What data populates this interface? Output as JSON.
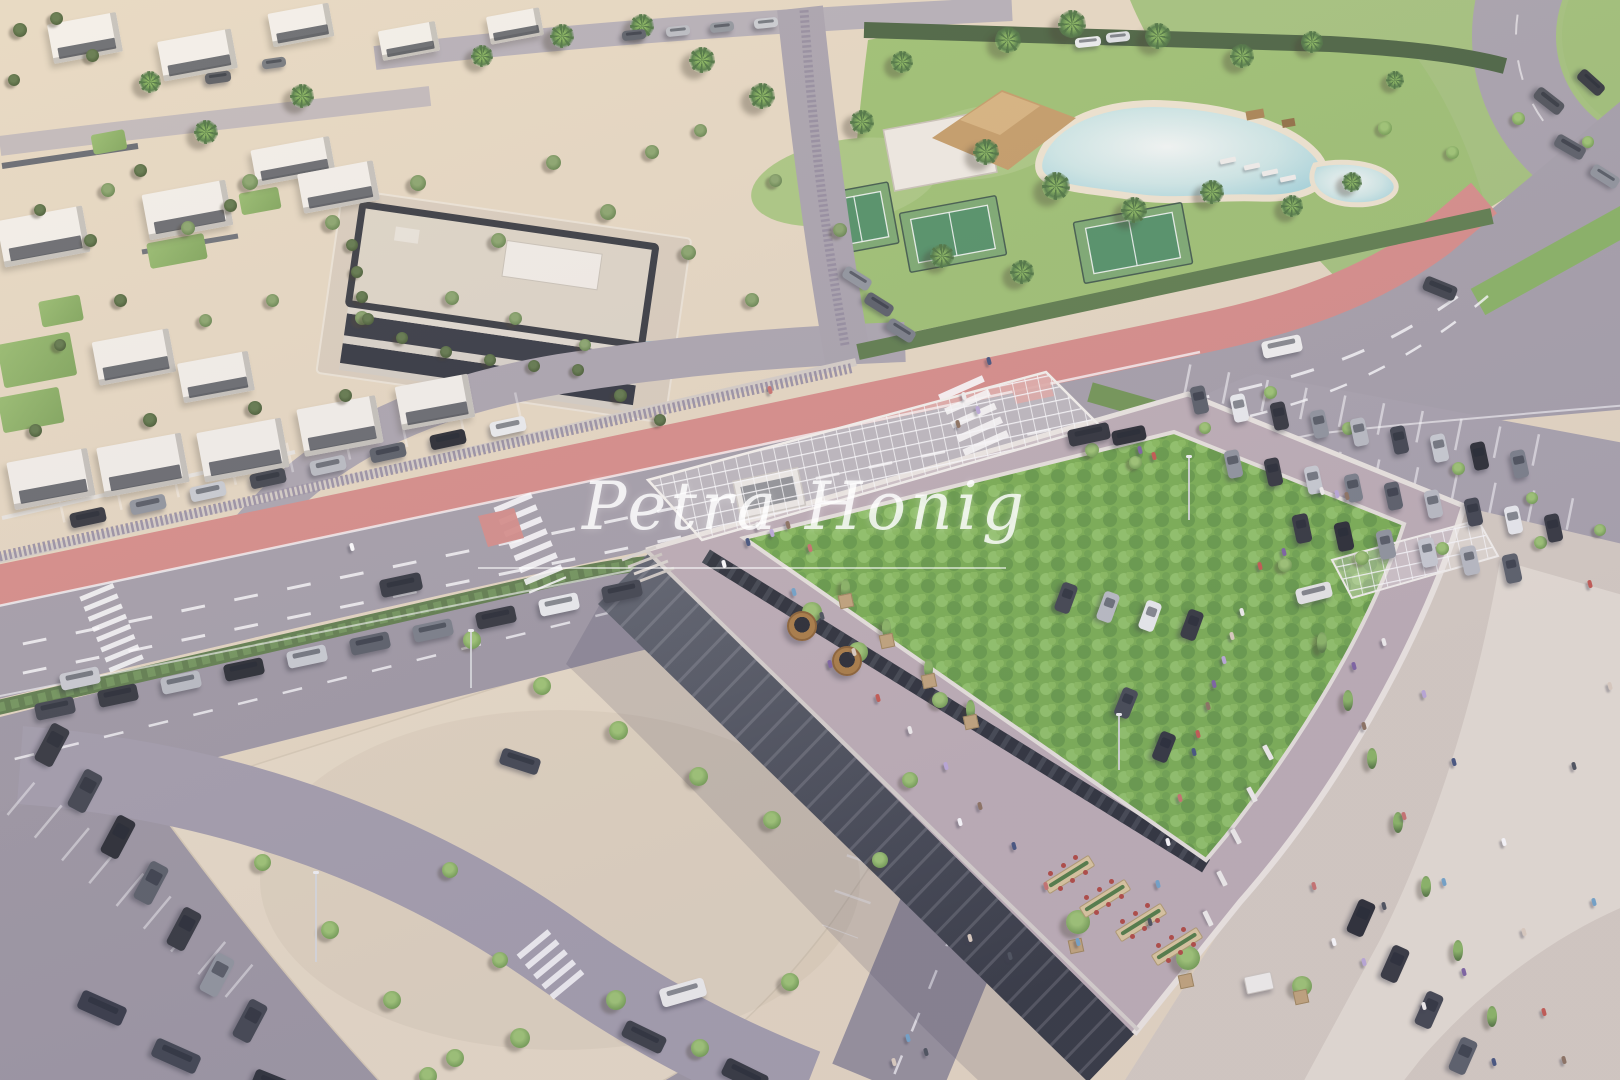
{
  "watermark": {
    "text": "Petra Honig"
  },
  "palette": {
    "car_colors": [
      "#2e3138",
      "#565b64",
      "#c9ccd1",
      "#3c4049",
      "#8e939b",
      "#eceeef",
      "#23262c",
      "#777c85",
      "#b9bcc2",
      "#4d525b"
    ],
    "people_colors": [
      "#f4f2ef",
      "#bba8d8",
      "#8a6f5a",
      "#40507a",
      "#c96f6a",
      "#ffffff",
      "#6fa3c9",
      "#474d56",
      "#decfbe",
      "#7a5fa0",
      "#c4554a"
    ],
    "green_roof": "#77ae4d",
    "bike_lane": "#d78b86",
    "road": "#a49ea8",
    "plaza": "#e8dbc5"
  },
  "scene": {
    "lawns": [
      [
        0,
        338,
        74,
        44
      ],
      [
        0,
        392,
        62,
        36
      ],
      [
        40,
        298,
        42,
        26
      ],
      [
        148,
        238,
        58,
        26
      ],
      [
        240,
        190,
        40,
        22
      ],
      [
        92,
        132,
        34,
        20
      ]
    ],
    "villas": [
      [
        50,
        18,
        70,
        40
      ],
      [
        160,
        35,
        75,
        40
      ],
      [
        270,
        8,
        62,
        34
      ],
      [
        380,
        26,
        58,
        30
      ],
      [
        488,
        12,
        54,
        28
      ],
      [
        145,
        187,
        85,
        46
      ],
      [
        253,
        143,
        80,
        36
      ],
      [
        300,
        167,
        77,
        40
      ],
      [
        0,
        213,
        87,
        47
      ],
      [
        95,
        335,
        78,
        44
      ],
      [
        180,
        357,
        72,
        40
      ],
      [
        10,
        455,
        82,
        48
      ],
      [
        100,
        440,
        86,
        50
      ],
      [
        200,
        425,
        86,
        50
      ],
      [
        300,
        402,
        80,
        48
      ],
      [
        398,
        380,
        74,
        44
      ]
    ],
    "trees": {
      "olive": [
        [
          250,
          182,
          16
        ],
        [
          332,
          222,
          15
        ],
        [
          418,
          183,
          16
        ],
        [
          498,
          240,
          15
        ],
        [
          608,
          212,
          16
        ],
        [
          688,
          252,
          15
        ],
        [
          752,
          300,
          14
        ],
        [
          652,
          152,
          14
        ],
        [
          553,
          162,
          15
        ],
        [
          452,
          298,
          14
        ],
        [
          362,
          318,
          14
        ],
        [
          272,
          300,
          13
        ],
        [
          188,
          228,
          14
        ],
        [
          108,
          190,
          14
        ],
        [
          205,
          320,
          13
        ],
        [
          515,
          318,
          13
        ],
        [
          585,
          345,
          12
        ],
        [
          700,
          130,
          13
        ],
        [
          775,
          180,
          13
        ],
        [
          840,
          230,
          14
        ]
      ],
      "dark": [
        [
          140,
          170,
          13
        ],
        [
          230,
          205,
          13
        ],
        [
          90,
          240,
          13
        ],
        [
          40,
          210,
          12
        ],
        [
          120,
          300,
          13
        ],
        [
          60,
          345,
          12
        ],
        [
          150,
          420,
          14
        ],
        [
          255,
          408,
          14
        ],
        [
          345,
          395,
          13
        ],
        [
          35,
          430,
          13
        ],
        [
          352,
          245,
          12
        ],
        [
          357,
          272,
          12
        ],
        [
          362,
          297,
          12
        ],
        [
          368,
          319,
          12
        ],
        [
          402,
          338,
          12
        ],
        [
          446,
          352,
          12
        ],
        [
          490,
          360,
          12
        ],
        [
          534,
          366,
          12
        ],
        [
          578,
          370,
          12
        ],
        [
          20,
          30,
          14
        ],
        [
          56,
          18,
          13
        ],
        [
          92,
          55,
          13
        ],
        [
          14,
          80,
          12
        ],
        [
          620,
          395,
          13
        ],
        [
          660,
          420,
          12
        ]
      ],
      "palm": [
        [
          1008,
          40,
          26
        ],
        [
          1072,
          24,
          28
        ],
        [
          1158,
          36,
          26
        ],
        [
          1242,
          56,
          24
        ],
        [
          1312,
          42,
          22
        ],
        [
          902,
          62,
          22
        ],
        [
          862,
          122,
          24
        ],
        [
          986,
          152,
          26
        ],
        [
          1056,
          186,
          28
        ],
        [
          1134,
          210,
          26
        ],
        [
          1212,
          192,
          24
        ],
        [
          1292,
          206,
          22
        ],
        [
          942,
          256,
          24
        ],
        [
          1022,
          272,
          24
        ],
        [
          762,
          96,
          26
        ],
        [
          702,
          60,
          26
        ],
        [
          642,
          26,
          24
        ],
        [
          562,
          36,
          24
        ],
        [
          482,
          56,
          22
        ],
        [
          302,
          96,
          24
        ],
        [
          206,
          132,
          24
        ],
        [
          150,
          82,
          22
        ],
        [
          1352,
          182,
          20
        ],
        [
          1395,
          80,
          18
        ]
      ],
      "bright": [
        [
          1385,
          128,
          14
        ],
        [
          1452,
          152,
          13
        ],
        [
          1518,
          118,
          13
        ],
        [
          1588,
          142,
          12
        ],
        [
          472,
          640,
          18
        ],
        [
          542,
          686,
          18
        ],
        [
          618,
          730,
          19
        ],
        [
          698,
          776,
          19
        ],
        [
          772,
          820,
          18
        ],
        [
          520,
          1038,
          20
        ],
        [
          616,
          1000,
          20
        ],
        [
          428,
          1076,
          18
        ],
        [
          262,
          862,
          17
        ],
        [
          330,
          930,
          18
        ],
        [
          392,
          1000,
          18
        ],
        [
          455,
          1058,
          18
        ],
        [
          700,
          1048,
          18
        ],
        [
          790,
          982,
          18
        ],
        [
          450,
          870,
          16
        ],
        [
          500,
          960,
          16
        ],
        [
          940,
          700,
          16
        ],
        [
          910,
          780,
          16
        ],
        [
          880,
          860,
          16
        ],
        [
          1270,
          392,
          13
        ],
        [
          1348,
          428,
          13
        ],
        [
          1458,
          468,
          13
        ],
        [
          1532,
          498,
          12
        ],
        [
          1600,
          530,
          12
        ],
        [
          1205,
          428,
          12
        ],
        [
          1135,
          462,
          13
        ],
        [
          1285,
          565,
          14
        ],
        [
          1362,
          558,
          14
        ],
        [
          1442,
          548,
          13
        ],
        [
          1540,
          542,
          13
        ],
        [
          1078,
          922,
          24
        ],
        [
          1188,
          958,
          24
        ],
        [
          1302,
          986,
          20
        ],
        [
          812,
          612,
          20
        ],
        [
          858,
          652,
          20
        ],
        [
          1092,
          450,
          14
        ]
      ],
      "cypress": [
        [
          1322,
          642,
          17
        ],
        [
          1348,
          700,
          17
        ],
        [
          1372,
          758,
          17
        ],
        [
          1398,
          822,
          17
        ],
        [
          1426,
          886,
          17
        ],
        [
          1458,
          950,
          17
        ],
        [
          1492,
          1016,
          17
        ],
        [
          845,
          588,
          15
        ],
        [
          886,
          628,
          15
        ],
        [
          928,
          668,
          15
        ],
        [
          970,
          709,
          15
        ]
      ]
    },
    "car_rows": [
      {
        "x": 70,
        "y": 510,
        "dx": 60,
        "dy": -13,
        "n": 8,
        "w": 36,
        "h": 15,
        "rot": -12,
        "cols": [
          0,
          4,
          2,
          3,
          8,
          1,
          6,
          5
        ]
      },
      {
        "x": 35,
        "y": 700,
        "dx": 63,
        "dy": -13,
        "n": 10,
        "w": 40,
        "h": 17,
        "rot": -12,
        "cols": [
          3,
          0,
          8,
          6,
          2,
          1,
          7,
          0,
          5,
          3
        ]
      },
      {
        "x": 1192,
        "y": 386,
        "dx": 40,
        "dy": 8,
        "n": 9,
        "w": 15,
        "h": 28,
        "rot": -12,
        "cols": [
          1,
          5,
          0,
          4,
          8,
          3,
          2,
          6,
          7
        ]
      },
      {
        "x": 1226,
        "y": 450,
        "dx": 40,
        "dy": 8,
        "n": 9,
        "w": 15,
        "h": 28,
        "rot": -12,
        "cols": [
          4,
          0,
          2,
          7,
          1,
          8,
          3,
          5,
          0
        ]
      },
      {
        "x": 1294,
        "y": 514,
        "dx": 42,
        "dy": 8,
        "n": 6,
        "w": 16,
        "h": 29,
        "rot": -12,
        "cols": [
          0,
          6,
          4,
          2,
          8,
          1
        ]
      },
      {
        "x": 1058,
        "y": 583,
        "dx": 42,
        "dy": 9,
        "n": 4,
        "w": 16,
        "h": 30,
        "rot": 20,
        "cols": [
          3,
          8,
          5,
          0
        ]
      },
      {
        "x": 42,
        "y": 724,
        "dx": 33,
        "dy": 46,
        "n": 7,
        "w": 20,
        "h": 42,
        "rot": 28,
        "cols": [
          0,
          3,
          6,
          1,
          0,
          4,
          3
        ]
      },
      {
        "x": 1352,
        "y": 900,
        "dx": 34,
        "dy": 46,
        "n": 4,
        "w": 18,
        "h": 36,
        "rot": 24,
        "cols": [
          6,
          0,
          3,
          1
        ]
      },
      {
        "x": 622,
        "y": 30,
        "dx": 44,
        "dy": -4,
        "n": 4,
        "w": 24,
        "h": 10,
        "rot": -6,
        "cols": [
          1,
          8,
          4,
          2
        ]
      },
      {
        "x": 842,
        "y": 272,
        "dx": 22,
        "dy": 26,
        "n": 3,
        "w": 30,
        "h": 13,
        "rot": 32,
        "cols": [
          4,
          1,
          7
        ]
      }
    ],
    "cars": [
      [
        380,
        576,
        -12,
        42,
        18,
        "#2f333b"
      ],
      [
        60,
        670,
        -12,
        40,
        17,
        "#caccd1"
      ],
      [
        1068,
        426,
        -12,
        42,
        17,
        "#2b2e35"
      ],
      [
        1262,
        338,
        -12,
        40,
        17,
        "#f2f2f0"
      ],
      [
        1296,
        585,
        -14,
        36,
        16,
        "#e9e9e7"
      ],
      [
        1423,
        281,
        22,
        34,
        15,
        "#3a3e45"
      ],
      [
        1533,
        94,
        38,
        32,
        14,
        "#4a4e55"
      ],
      [
        1576,
        76,
        42,
        30,
        13,
        "#2e3238"
      ],
      [
        1554,
        140,
        30,
        32,
        14,
        "#565b63"
      ],
      [
        1590,
        170,
        32,
        30,
        13,
        "#8d929a"
      ],
      [
        500,
        753,
        18,
        40,
        17,
        "#3c414b"
      ],
      [
        660,
        983,
        -16,
        46,
        19,
        "#f0f0ee"
      ],
      [
        622,
        1028,
        26,
        44,
        18,
        "#34383f"
      ],
      [
        722,
        1066,
        26,
        46,
        19,
        "#2c3037"
      ],
      [
        78,
        998,
        24,
        48,
        20,
        "#303440"
      ],
      [
        152,
        1046,
        24,
        48,
        20,
        "#3a3f49"
      ],
      [
        252,
        1076,
        22,
        46,
        19,
        "#262a31"
      ],
      [
        1118,
        688,
        22,
        16,
        30,
        "#3f444d"
      ],
      [
        1156,
        732,
        22,
        16,
        30,
        "#2b2f37"
      ],
      [
        1075,
        37,
        -6,
        26,
        10,
        "#eceeef"
      ],
      [
        1106,
        32,
        -6,
        24,
        10,
        "#dfe2e4"
      ],
      [
        205,
        72,
        -8,
        26,
        11,
        "#55585e"
      ],
      [
        262,
        58,
        -8,
        24,
        10,
        "#70747a"
      ],
      [
        1112,
        428,
        -12,
        34,
        15,
        "#23262c"
      ]
    ],
    "people": [
      [
        756,
        522
      ],
      [
        770,
        529
      ],
      [
        786,
        521
      ],
      [
        746,
        538
      ],
      [
        808,
        544
      ],
      [
        722,
        560
      ],
      [
        792,
        588
      ],
      [
        820,
        612
      ],
      [
        852,
        648
      ],
      [
        828,
        660
      ],
      [
        876,
        694
      ],
      [
        908,
        726
      ],
      [
        944,
        762
      ],
      [
        978,
        802
      ],
      [
        1012,
        842
      ],
      [
        1044,
        882
      ],
      [
        958,
        818
      ],
      [
        1076,
        938
      ],
      [
        1008,
        952
      ],
      [
        968,
        934
      ],
      [
        1282,
        548
      ],
      [
        1258,
        562
      ],
      [
        1240,
        608
      ],
      [
        1222,
        656
      ],
      [
        1206,
        702
      ],
      [
        1192,
        748
      ],
      [
        1178,
        794
      ],
      [
        1166,
        838
      ],
      [
        1156,
        880
      ],
      [
        1148,
        918
      ],
      [
        1230,
        632
      ],
      [
        1212,
        680
      ],
      [
        1196,
        730
      ],
      [
        1382,
        638
      ],
      [
        1422,
        690
      ],
      [
        1362,
        722
      ],
      [
        1452,
        758
      ],
      [
        1402,
        812
      ],
      [
        1502,
        838
      ],
      [
        1442,
        878
      ],
      [
        1382,
        902
      ],
      [
        1522,
        928
      ],
      [
        1462,
        968
      ],
      [
        1542,
        1008
      ],
      [
        1422,
        1002
      ],
      [
        1362,
        958
      ],
      [
        1562,
        1056
      ],
      [
        1492,
        1058
      ],
      [
        1312,
        882
      ],
      [
        1332,
        938
      ],
      [
        1592,
        898
      ],
      [
        1572,
        762
      ],
      [
        1608,
        682
      ],
      [
        1352,
        662
      ],
      [
        1588,
        580
      ],
      [
        962,
        392
      ],
      [
        976,
        406
      ],
      [
        956,
        420
      ],
      [
        987,
        357
      ],
      [
        768,
        386
      ],
      [
        350,
        543
      ],
      [
        906,
        1034
      ],
      [
        924,
        1048
      ],
      [
        892,
        1058
      ],
      [
        1138,
        446
      ],
      [
        1152,
        452
      ],
      [
        1320,
        487
      ],
      [
        1335,
        490
      ],
      [
        1345,
        492
      ]
    ],
    "tables": [
      [
        1042,
        868
      ],
      [
        1078,
        892
      ],
      [
        1114,
        916
      ],
      [
        1150,
        940
      ]
    ],
    "kiosks": [
      [
        800,
        624,
        13
      ],
      [
        845,
        659,
        13
      ]
    ],
    "cart": [
      1258,
      982
    ],
    "benches": [
      [
        1268,
        752,
        62
      ],
      [
        1252,
        794,
        62
      ],
      [
        1236,
        836,
        62
      ],
      [
        1222,
        878,
        63
      ],
      [
        1208,
        918,
        64
      ],
      [
        1252,
        166,
        -12
      ],
      [
        1270,
        172,
        -12
      ],
      [
        1288,
        178,
        -12
      ],
      [
        1228,
        160,
        -12
      ]
    ],
    "planters": [
      [
        845,
        600
      ],
      [
        886,
        640
      ],
      [
        928,
        680
      ],
      [
        970,
        721
      ],
      [
        1075,
        945
      ],
      [
        1185,
        980
      ],
      [
        1300,
        996
      ]
    ],
    "poles": [
      [
        315,
        962,
        88
      ],
      [
        1188,
        520,
        62
      ],
      [
        470,
        688,
        56
      ],
      [
        1118,
        770,
        54
      ]
    ]
  }
}
